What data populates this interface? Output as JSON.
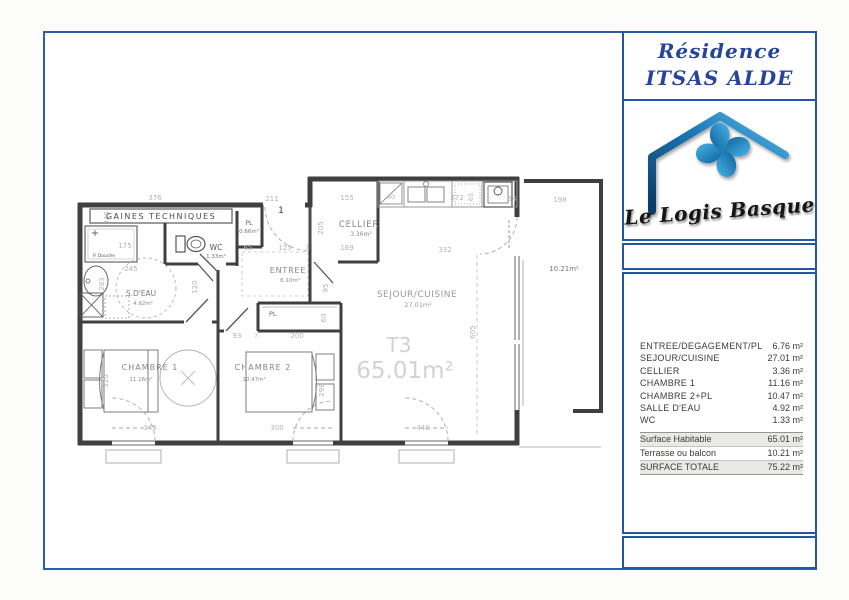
{
  "header": {
    "title_line1": "Résidence",
    "title_line2": "ITSAS ALDE"
  },
  "logo": {
    "text": "Le Logis Basque"
  },
  "plan": {
    "unit": {
      "type": "T3",
      "area": "65.01m²"
    },
    "labels": {
      "gaines": "GAINES TECHNIQUES",
      "door_number": "1",
      "p_douche": "P. Douche"
    },
    "rooms": {
      "sdeau": {
        "name": "S.D'EAU",
        "area": "4.92m²"
      },
      "wc": {
        "name": "WC",
        "area": "1.33m²"
      },
      "pl_entree": {
        "name": "PL",
        "area": "0.66m²"
      },
      "entree": {
        "name": "ENTREE",
        "area": "6.10m²"
      },
      "cellier": {
        "name": "CELLIER",
        "area": "3.36m²"
      },
      "sejour": {
        "name": "SEJOUR/CUISINE",
        "area": "27.01m²"
      },
      "chambre1": {
        "name": "CHAMBRE  1",
        "area": "11.16m²"
      },
      "chambre2": {
        "name": "CHAMBRE  2",
        "area": "10.47m²"
      },
      "pl_chambre2": {
        "name": "PL"
      },
      "terrasse": {
        "area": "10.21m²"
      }
    },
    "dims": {
      "top_376": "376",
      "top_211": "211",
      "top_155": "155",
      "top_272": "272",
      "top_34": "34",
      "top_198": "198",
      "left_840": "840",
      "left_283": "283",
      "left_320": "320",
      "mid_175": "175",
      "mid_245": "245",
      "mid_65": "65",
      "mid_125": "125",
      "mid_7": "7",
      "mid_169": "169",
      "mid_205": "205",
      "mid_95": "95",
      "mid_120": "120",
      "mid_332": "332",
      "kitchen_60": "60",
      "kitchen_65": "65",
      "low_93": "93",
      "low_7": "7",
      "low_200": "200",
      "low_60": "60",
      "low_298": "298",
      "bot_345": "345",
      "bot_300": "300",
      "bot_440": "440",
      "right_605": "605"
    }
  },
  "table": {
    "rows": [
      {
        "label": "ENTREE/DEGAGEMENT/PL",
        "value": "6.76 m²"
      },
      {
        "label": "SEJOUR/CUISINE",
        "value": "27.01 m²"
      },
      {
        "label": "CELLIER",
        "value": "3.36 m²"
      },
      {
        "label": "CHAMBRE 1",
        "value": "11.16 m²"
      },
      {
        "label": "CHAMBRE 2+PL",
        "value": "10.47 m²"
      },
      {
        "label": "SALLE D'EAU",
        "value": "4.92 m²"
      },
      {
        "label": "WC",
        "value": "1.33 m²"
      }
    ],
    "summary": [
      {
        "label": "Surface Habitable",
        "value": "65.01 m²"
      },
      {
        "label": "Terrasse ou balcon",
        "value": "10.21 m²"
      },
      {
        "label": "SURFACE TOTALE",
        "value": "75.22 m²"
      }
    ]
  }
}
